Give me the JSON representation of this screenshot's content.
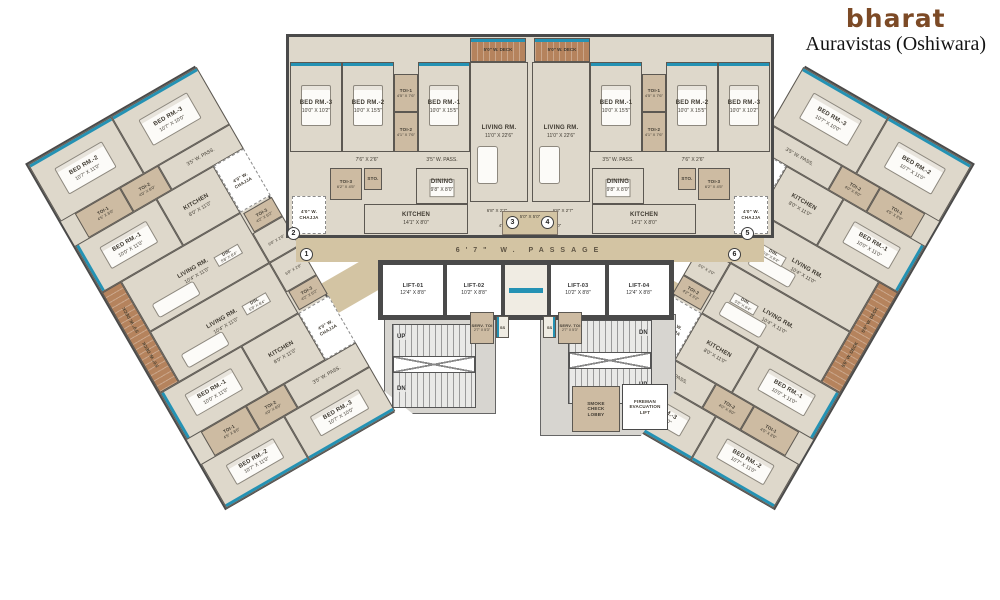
{
  "header": {
    "logo_text": "bharat",
    "project_title": "Auravistas (Oshiwara)"
  },
  "unit_numbers": {
    "u1": "1",
    "u2": "2",
    "u3": "3",
    "u4": "4",
    "u5": "5",
    "u6": "6"
  },
  "center_unit": {
    "deck": {
      "name": "5'0\" W. DECK"
    },
    "living": {
      "name": "LIVING RM.",
      "size": "11'0\" X 22'6\""
    },
    "bed1": {
      "name": "BED RM.-1",
      "size": "10'0\" X 15'5\""
    },
    "bed2": {
      "name": "BED RM.-2",
      "size": "10'0\" X 15'5\""
    },
    "bed3": {
      "name": "BED RM.-3",
      "size": "10'0\" X 10'2\""
    },
    "toi1": {
      "name": "TOI-1",
      "size": "4'5\" X 7'6\""
    },
    "toi2": {
      "name": "TOI-2",
      "size": "4'1\" X 7'6\""
    },
    "toi3": {
      "name": "TOI-3",
      "size": "6'2\" X 4'5\""
    },
    "sto": {
      "name": "STO."
    },
    "corridor": {
      "size": "7'6\" X 2'6\""
    },
    "pass": {
      "name": "3'5\" W. PASS."
    },
    "dining": {
      "name": "DINING",
      "size": "9'8\" X 8'0\""
    },
    "kitchen": {
      "name": "KITCHEN",
      "size": "14'1\" X 8'0\""
    },
    "kpass": {
      "size": "6'8\" X 2'7\""
    },
    "chajja": {
      "name": "4'0\" W.",
      "name2": "CHAJJA"
    },
    "foyer": {
      "size": "4'0\" X 5'0\""
    },
    "lobby": {
      "size": "5'0\" X 5'0\""
    }
  },
  "wing_unit": {
    "bed1": {
      "name": "BED RM.-1",
      "size": "10'0\" X 11'0\""
    },
    "bed2": {
      "name": "BED RM.-2",
      "size": "10'7\" X 11'0\""
    },
    "bed3": {
      "name": "BED RM.-3",
      "size": "10'7\" X 10'0\""
    },
    "toi1": {
      "name": "TOI-1",
      "size": "4'5\" X 8'0\""
    },
    "toi2": {
      "name": "TOI-2",
      "size": "4'0\" X 8'0\""
    },
    "toi3": {
      "name": "TOI-3",
      "size": "4'2\" X 6'2\""
    },
    "pass": {
      "name": "3'5\" W. PASS."
    },
    "kitchen": {
      "name": "KITCHEN",
      "size": "8'0\" X 11'0\""
    },
    "din": {
      "name": "DIN.",
      "size": "5'8\" X 8'4\""
    },
    "living": {
      "name": "LIVING RM.",
      "size": "10'4\" X 11'0\""
    },
    "deck": {
      "name": "5'0\" W. DECK"
    },
    "chajja": {
      "name": "4'0\" W.",
      "name2": "CHAJJA"
    },
    "foyer": {
      "size": "6'0\" X 2'0\""
    }
  },
  "core": {
    "passage": "6'7\" W. PASSAGE",
    "lifts": [
      {
        "name": "LIFT-01",
        "size": "12'4\" X 8'8\""
      },
      {
        "name": "LIFT-02",
        "size": "10'2\" X 8'8\""
      },
      {
        "name": "LIFT-03",
        "size": "10'2\" X 8'8\""
      },
      {
        "name": "LIFT-04",
        "size": "12'4\" X 8'8\""
      }
    ],
    "serv_toi": {
      "name": "SERV. TOI",
      "size": "2'7\" X 5'3\""
    },
    "ss": "SS",
    "up": "UP",
    "dn": "DN",
    "smoke_lobby": "SMOKE CHECK LOBBY",
    "fireman_lift": "FIREMAN EVACUATION LIFT"
  },
  "colors": {
    "accent_teal": "#2492b4",
    "wall_dark": "#4a4a4a",
    "floor": "#ded8cb",
    "toilet_tan": "#cdbba2",
    "deck_wood": "#b5835d",
    "sand": "#d3c4a3",
    "stair_gray": "#d7d5d0",
    "logo_brown": "#7c4a26"
  }
}
